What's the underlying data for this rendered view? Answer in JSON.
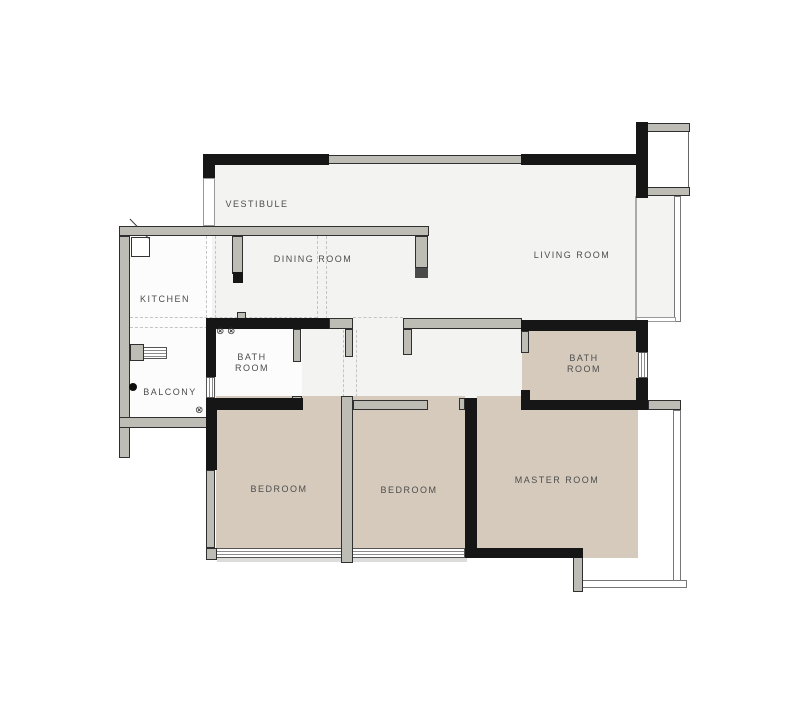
{
  "plan_title": "apartment floor plan",
  "colors": {
    "wall_black": "#161616",
    "wall_gray": "#bdbdb5",
    "wall_outline": "#2f2f2f",
    "floor_light": "#f3f3f2",
    "floor_white": "#fcfcfc",
    "floor_tan": "#d5cabb",
    "label_text": "#4d4d4d"
  },
  "rooms": [
    {
      "id": "vestibule",
      "name": "VESTIBULE"
    },
    {
      "id": "dining-room",
      "name": "DINING ROOM"
    },
    {
      "id": "living-room",
      "name": "LIVING ROOM"
    },
    {
      "id": "kitchen",
      "name": "KITCHEN"
    },
    {
      "id": "bathroom-1",
      "name": "BATH ROOM"
    },
    {
      "id": "balcony",
      "name": "BALCONY"
    },
    {
      "id": "bathroom-2",
      "name": "BATH ROOM"
    },
    {
      "id": "bedroom-1",
      "name": "BEDROOM"
    },
    {
      "id": "bedroom-2",
      "name": "BEDROOM"
    },
    {
      "id": "master-room",
      "name": "MASTER ROOM"
    }
  ],
  "symbols": {
    "vent": "⊗"
  }
}
